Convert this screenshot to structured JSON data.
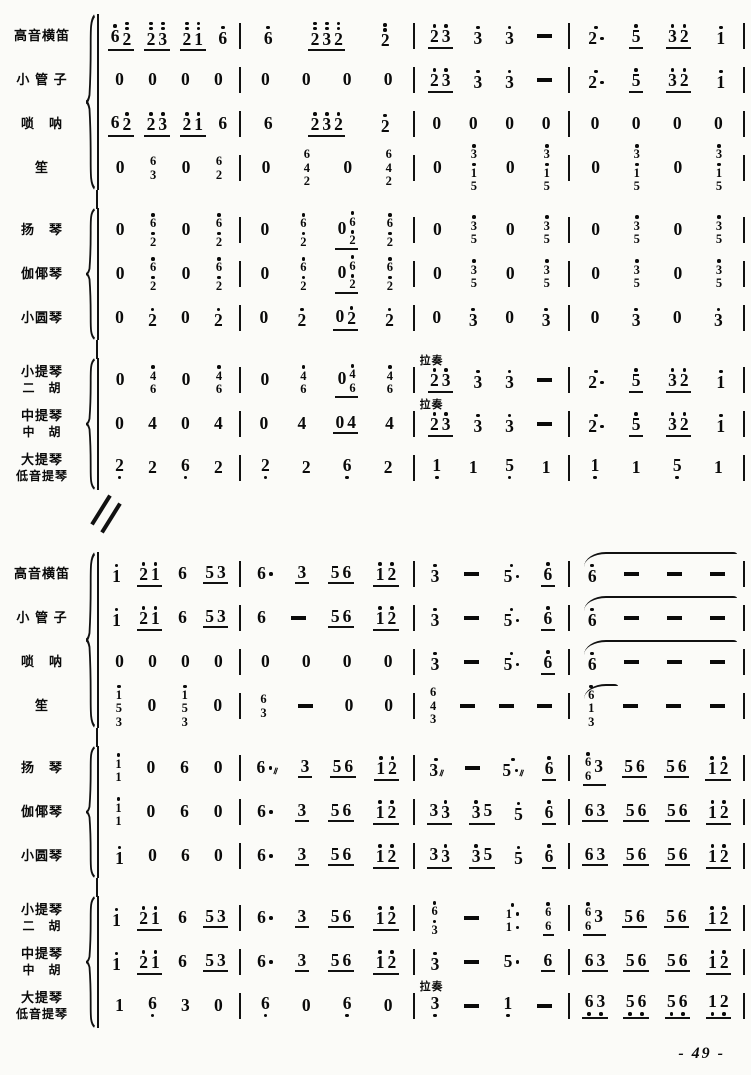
{
  "page": {
    "number_label": "- 49 -"
  },
  "annotations": {
    "bowed": "拉奏"
  },
  "systems": [
    {
      "groups": [
        {
          "rows": [
            {
              "label": [
                "高音横笛"
              ],
              "measures": [
                "(6'2'') (2''3'') (2''1'') 6'",
                "6' (2''3''2'') 2''",
                "(2'3') 3' 3' -",
                "2'. (5') (3'2') 1'"
              ]
            },
            {
              "label": [
                "小 管 子"
              ],
              "measures": [
                "0 0 0 0",
                "0 0 0 0",
                "(2'3') 3' 3' -",
                "2'. (5') (3'2') 1'"
              ]
            },
            {
              "label": [
                "唢　呐"
              ],
              "measures": [
                "(62') (2'3') (2'1') 6",
                "6 (2'3'2') 2'",
                "0 0 0 0",
                "0 0 0 0"
              ]
            },
            {
              "label": [
                "笙"
              ],
              "measures": [
                "0 6/3 0 6/2",
                "0 6/4/2 0 6/4/2",
                "0 3'/1'/5 0 3'/1'/5",
                "0 3'/1'/5 0 3'/1'/5"
              ]
            }
          ]
        },
        {
          "rows": [
            {
              "label": [
                "扬　琴"
              ],
              "measures": [
                "0 6'/2' 0 6'/2'",
                "0 6'/2' (06'/2') 6'/2'",
                "0 3'/5 0 3'/5",
                "0 3'/5 0 3'/5"
              ]
            },
            {
              "label": [
                "伽倻琴"
              ],
              "measures": [
                "0 6'/2' 0 6'/2'",
                "0 6'/2' (06'/2') 6'/2'",
                "0 3'/5 0 3'/5",
                "0 3'/5 0 3'/5"
              ]
            },
            {
              "label": [
                "小圆琴"
              ],
              "measures": [
                "0 2' 0 2'",
                "0 2' (02') 2'",
                "0 3' 0 3'",
                "0 3' 0 3'"
              ]
            }
          ]
        },
        {
          "rows": [
            {
              "label": [
                "小提琴",
                "二　胡"
              ],
              "measures": [
                "0 4'/6 0 4'/6",
                "0 4'/6 (04'/6) 4'/6",
                {
                  "t": "(2'3') 3' 3' -",
                  "ann": 1
                },
                "2'. (5') (3'2') 1'"
              ]
            },
            {
              "label": [
                "中提琴",
                "中　胡"
              ],
              "measures": [
                "0 4 0 4",
                "0 4 (04) 4",
                {
                  "t": "(2'3') 3' 3' -",
                  "ann": 1
                },
                "2'. (5') (3'2') 1'"
              ]
            },
            {
              "label": [
                "大提琴",
                "低音提琴"
              ],
              "measures": [
                "2, 2 6, 2",
                "2, 2 6, 2",
                "1, 1 5, 1",
                "1, 1 5, 1"
              ]
            }
          ]
        }
      ]
    },
    {
      "groups": [
        {
          "rows": [
            {
              "label": [
                "高音横笛"
              ],
              "measures": [
                "1' (2'1') 6 (53)",
                "6. (3) (56) (1'2')",
                "3' - 5'. (6')",
                {
                  "t": "6' - - -",
                  "tie": 1
                }
              ]
            },
            {
              "label": [
                "小 管 子"
              ],
              "measures": [
                "1' (2'1') 6 (53)",
                "6 - (56) (1'2')",
                "3' - 5'. (6')",
                {
                  "t": "6' - - -",
                  "tie": 1
                }
              ]
            },
            {
              "label": [
                "唢　呐"
              ],
              "measures": [
                "0 0 0 0",
                "0 0 0 0",
                "3' - 5'. (6')",
                {
                  "t": "6' - - -",
                  "tie": 1
                }
              ]
            },
            {
              "label": [
                "笙"
              ],
              "measures": [
                "1'/5/3 0 1'/5/3 0",
                "6/3 - 0 0",
                "6/4/3 - - -",
                {
                  "t": "6'/1/3 - - -",
                  "tie": 2
                }
              ]
            }
          ]
        },
        {
          "rows": [
            {
              "label": [
                "扬　琴"
              ],
              "measures": [
                "1'/1 0 6 0",
                "6.~ (3) (56) (1'2')",
                "3'~ - 5'.~ (6')",
                "(6'/63) (56) (56) (1'2')"
              ]
            },
            {
              "label": [
                "伽倻琴"
              ],
              "measures": [
                "1'/1 0 6 0",
                "6. (3) (56) (1'2')",
                "(33') (3'5) 5' (6')",
                "(63) (56) (56) (1'2')"
              ]
            },
            {
              "label": [
                "小圆琴"
              ],
              "measures": [
                "1' 0 6 0",
                "6. (3) (56) (1'2')",
                "(33') (3'5) 5' (6')",
                "(63) (56) (56) (1'2')"
              ]
            }
          ]
        },
        {
          "rows": [
            {
              "label": [
                "小提琴",
                "二　胡"
              ],
              "measures": [
                "1' (2'1') 6 (53)",
                "6. (3) (56) (1'2')",
                "6'/3' - 1'./1. (6'/6)",
                "(6'/63) (56) (56) (1'2')"
              ]
            },
            {
              "label": [
                "中提琴",
                "中　胡"
              ],
              "measures": [
                "1' (2'1') 6 (53)",
                "6. (3) (56) (1'2')",
                "3' - 5. (6)",
                "(63) (56) (56) (1'2')"
              ]
            },
            {
              "label": [
                "大提琴",
                "低音提琴"
              ],
              "measures": [
                "1 6, 3 0",
                "6, 0 6, 0",
                {
                  "t": "3, - 1, -",
                  "ann": 1
                },
                "(6,3,) (5,6,) (5,6,) (1,2,)"
              ]
            }
          ]
        }
      ]
    }
  ]
}
